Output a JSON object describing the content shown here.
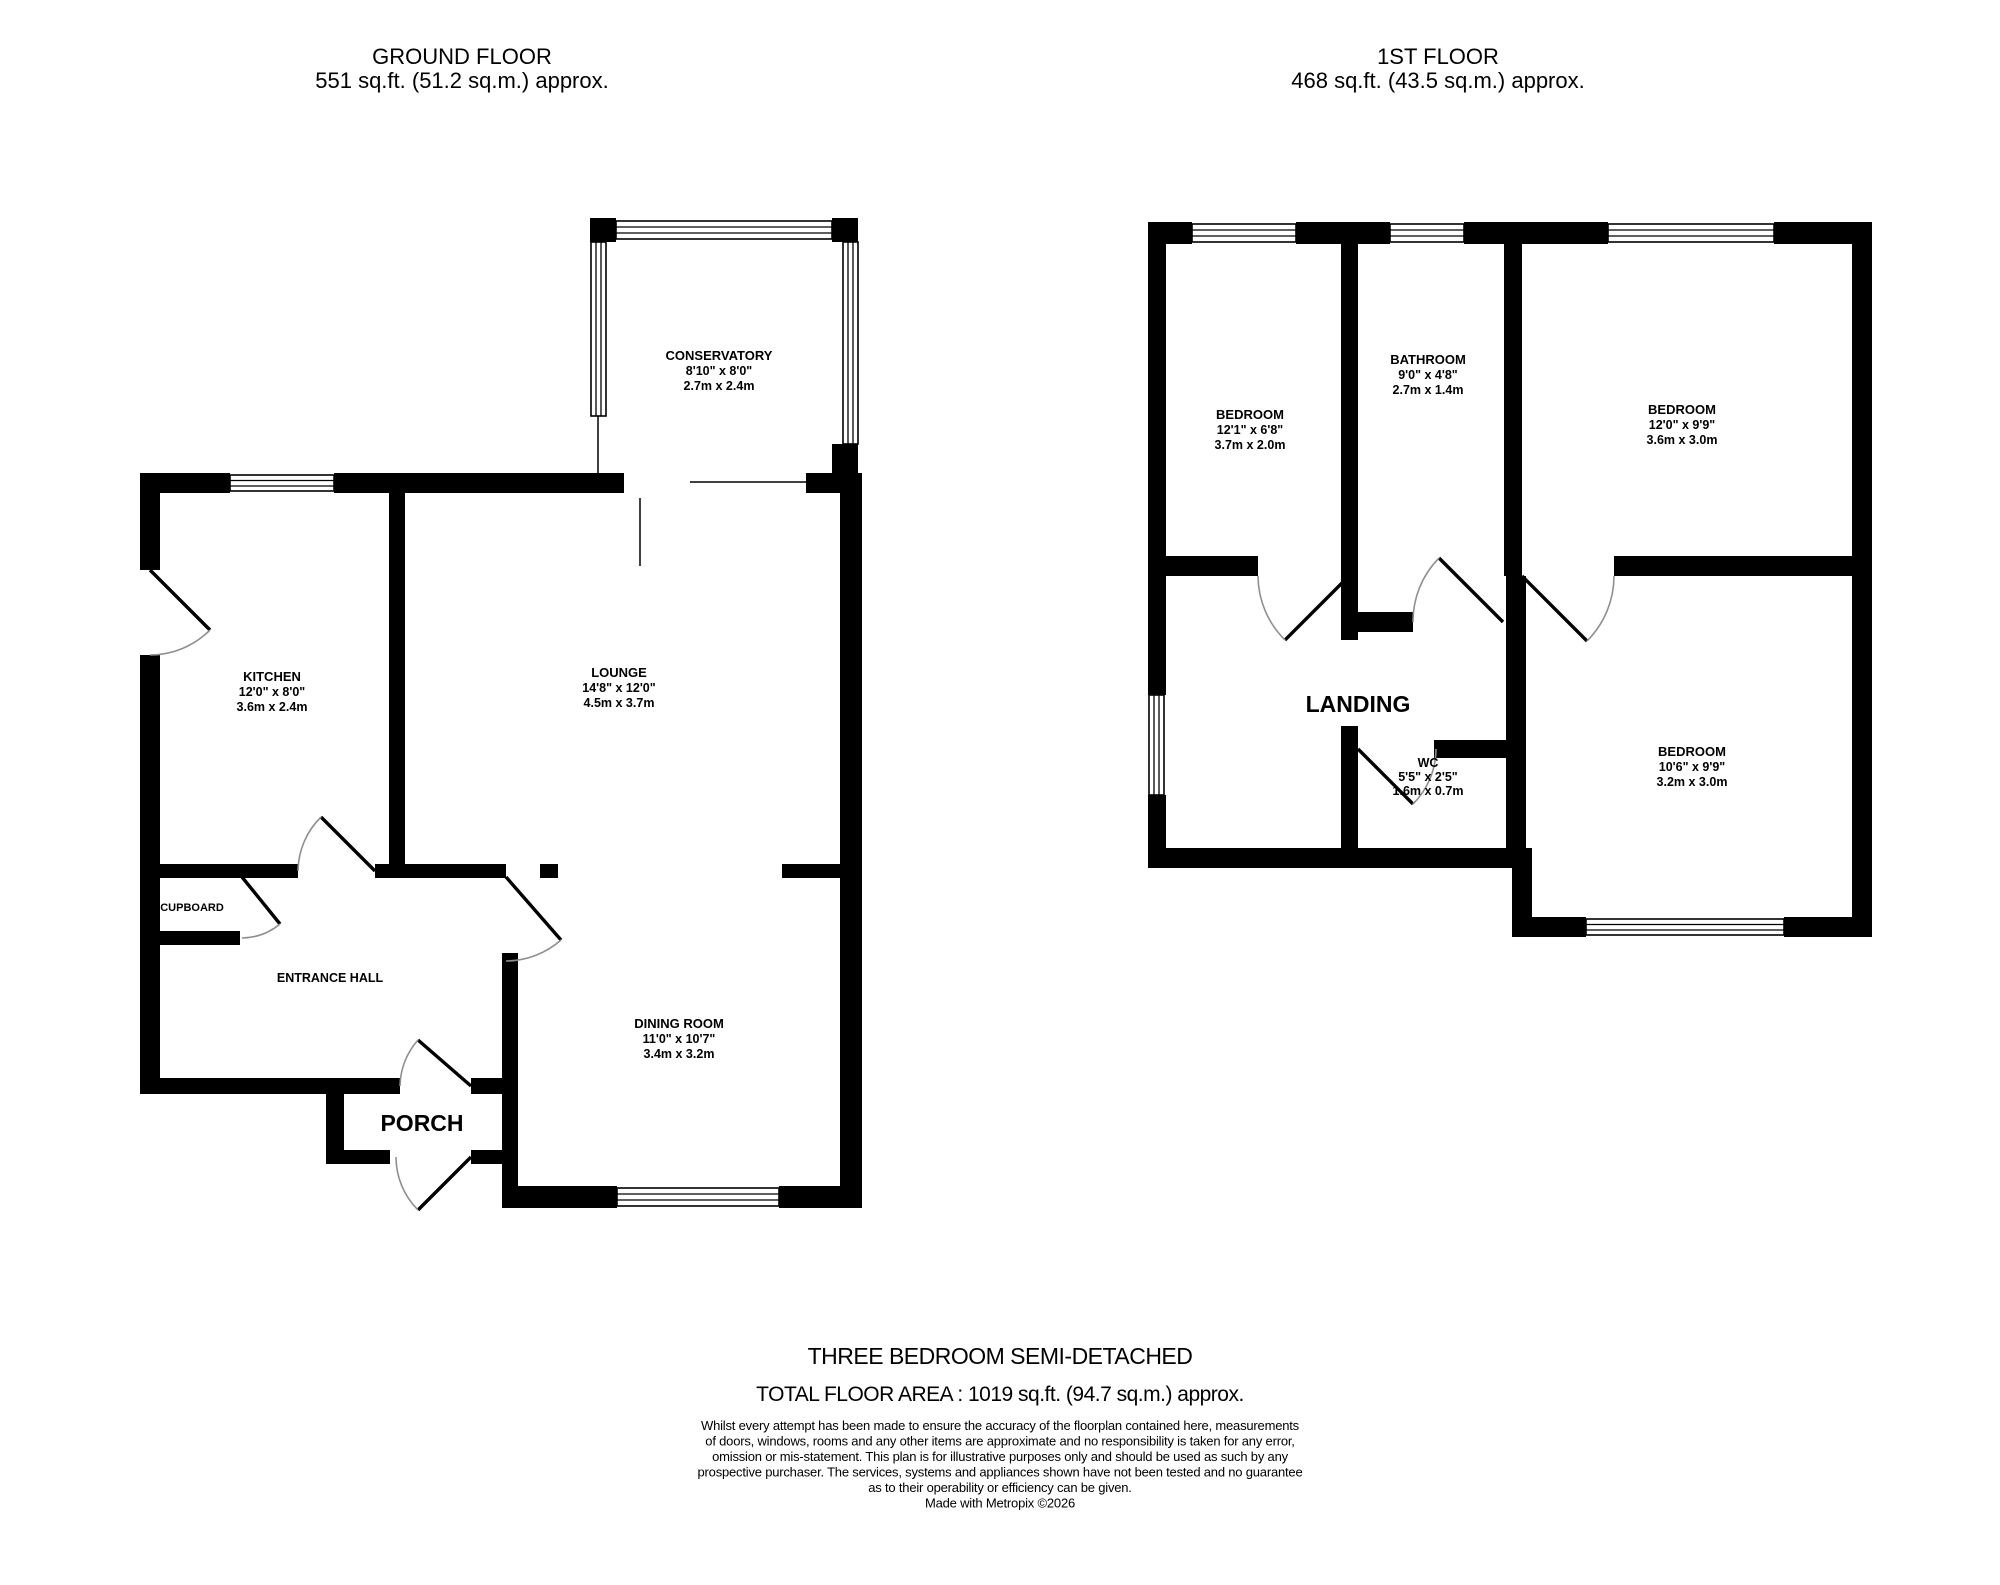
{
  "ground_floor": {
    "title": "GROUND FLOOR",
    "area_label": "551 sq.ft. (51.2 sq.m.) approx.",
    "rooms": {
      "conservatory": {
        "name": "CONSERVATORY",
        "imperial": "8'10\" x 8'0\"",
        "metric": "2.7m x 2.4m"
      },
      "kitchen": {
        "name": "KITCHEN",
        "imperial": "12'0\" x 8'0\"",
        "metric": "3.6m x 2.4m"
      },
      "lounge": {
        "name": "LOUNGE",
        "imperial": "14'8\" x 12'0\"",
        "metric": "4.5m x 3.7m"
      },
      "dining_room": {
        "name": "DINING ROOM",
        "imperial": "11'0\" x 10'7\"",
        "metric": "3.4m x 3.2m"
      },
      "cupboard": {
        "name": "CUPBOARD"
      },
      "entrance_hall": {
        "name": "ENTRANCE HALL"
      },
      "porch": {
        "name": "PORCH"
      }
    }
  },
  "first_floor": {
    "title": "1ST FLOOR",
    "area_label": "468 sq.ft. (43.5 sq.m.) approx.",
    "rooms": {
      "bedroom1": {
        "name": "BEDROOM",
        "imperial": "12'1\" x 6'8\"",
        "metric": "3.7m x 2.0m"
      },
      "bathroom": {
        "name": "BATHROOM",
        "imperial": "9'0\" x 4'8\"",
        "metric": "2.7m x 1.4m"
      },
      "bedroom2": {
        "name": "BEDROOM",
        "imperial": "12'0\" x 9'9\"",
        "metric": "3.6m x 3.0m"
      },
      "bedroom3": {
        "name": "BEDROOM",
        "imperial": "10'6\" x 9'9\"",
        "metric": "3.2m x 3.0m"
      },
      "wc": {
        "name": "WC",
        "imperial": "5'5\" x 2'5\"",
        "metric": "1.6m x 0.7m"
      },
      "landing": {
        "name": "LANDING"
      }
    }
  },
  "footer": {
    "property_type": "THREE BEDROOM SEMI-DETACHED",
    "total_area": "TOTAL FLOOR AREA : 1019 sq.ft. (94.7 sq.m.) approx.",
    "disclaimer_lines": [
      "Whilst every attempt has been made to ensure the accuracy of the floorplan contained here, measurements",
      "of doors, windows, rooms and any other items are approximate and no responsibility is taken for any error,",
      "omission or mis-statement. This plan is for illustrative purposes only and should be used as such by any",
      "prospective purchaser. The services, systems and appliances shown have not been tested and no guarantee",
      "as to their operability or efficiency can be given.",
      "Made with Metropix ©2026"
    ]
  },
  "colors": {
    "wall": "#000000",
    "door_arc": "#8f8f8f",
    "text": "#000000",
    "background": "#ffffff"
  }
}
